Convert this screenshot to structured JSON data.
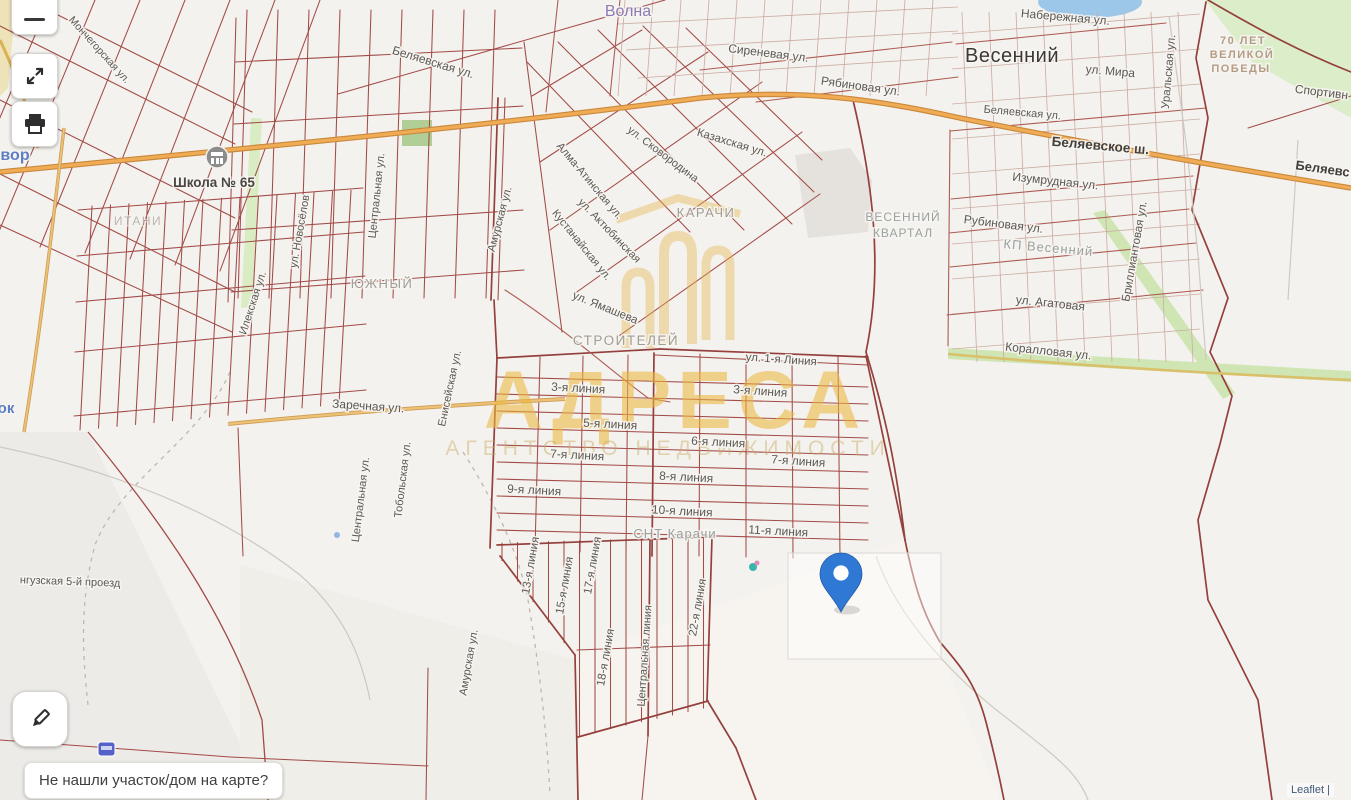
{
  "ui": {
    "feedback_prompt": "Не нашли участок/дом на карте?",
    "attribution": "Leaflet |",
    "icons": {
      "zoom_out": "minus-icon",
      "fullscreen": "expand-icon",
      "print": "printer-icon",
      "draw": "pencil-icon",
      "marker": "map-pin-icon",
      "school": "school-icon"
    }
  },
  "watermark": {
    "title": "АДРЕСА",
    "subtitle": "АГЕНТСТВО НЕДВИЖИМОСТИ"
  },
  "colors": {
    "parcel_lines": "#a24b47",
    "highway": "#eda855",
    "green_area": "#d8ebc2",
    "water": "#9cc7e8",
    "pin": "#2f78d3",
    "watermark_gold": "#ecb740"
  },
  "map": {
    "labels": {
      "volna": "Волна",
      "sirenevaya": "Сиреневая ул.",
      "ryabinovaya": "Рябиновая ул.",
      "naberezhnaya": "Набережная ул.",
      "vesenniy": "Весенний",
      "ul_mira": "ул. Мира",
      "uralskaya": "Уральская ул.",
      "pobedy_1": "70 ЛЕТ",
      "pobedy_2": "ВЕЛИКОЙ",
      "pobedy_3": "ПОБЕДЫ",
      "sportivnaya": "Спортивн",
      "belyaevskaya_top": "Беляевская ул.",
      "belyaevskaya_right": "Беляевская ул.",
      "belyaevskoe_sh": "Беляевское ш.",
      "belyaev_cut": "Беляевс",
      "izumrudnaya": "Изумрудная ул.",
      "rubinovaya": "Рубиновая ул.",
      "kp_vesenniy": "КП Весенний",
      "agatovaya": "ул. Агатовая",
      "brilliantovaya": "Бриллиантовая ул.",
      "korallovaya": "Коралловая ул.",
      "shkola": "Школа № 65",
      "itani": "ИТАНИ",
      "yuzhny": "ЮЖНЫЙ",
      "zarechnaya": "Заречная ул.",
      "ilekskaya": "Илекская ул.",
      "novosyolov": "ул. Новосёлов",
      "centralnaya_top": "Центральная ул.",
      "centralnaya_bottom": "Центральная ул.",
      "tobolskaya": "Тобольская ул.",
      "eniseyskaya": "Енисейская ул.",
      "amurskaya_top": "Амурская ул.",
      "amurskaya_bottom": "Амурская ул.",
      "monchegorskaya": "Мончегорская ул.",
      "vor": "вор",
      "ok": "ок",
      "nguzskaya": "нгузская 5-й проезд",
      "karachi": "КАРАЧИ",
      "stroiteley": "СТРОИТЕЛЕЙ",
      "yamasheva": "ул. Ямашева",
      "kazakhskaya": "Казахская ул.",
      "skovorodina": "ул. Сковородина",
      "alma_atinskaya": "Алма-Атинская ул.",
      "kustanayskaya": "Кустанайская ул.",
      "aktyubinskaya": "ул. Актюбинская",
      "vesenniy_kvartal_1": "ВЕСЕННИЙ",
      "vesenniy_kvartal_2": "КВАРТАЛ",
      "liniya_1": "ул. 1-я Линия",
      "liniya_3a": "3-я линия",
      "liniya_3b": "3-я линия",
      "liniya_5": "5-я линия",
      "liniya_6": "6-я линия",
      "liniya_7a": "7-я линия",
      "liniya_7b": "7-я линия",
      "liniya_8": "8-я линия",
      "liniya_9": "9-я линия",
      "liniya_10": "10-я линия",
      "liniya_11": "11-я линия",
      "snt_karachi": "СНТ Карачи",
      "liniya_13": "13-я линия",
      "liniya_15": "15-я линия",
      "liniya_17": "17-я линия",
      "liniya_18": "18-я линия",
      "centralnaya_liniya": "Центральная линия",
      "liniya_22": "22-я линия"
    }
  }
}
